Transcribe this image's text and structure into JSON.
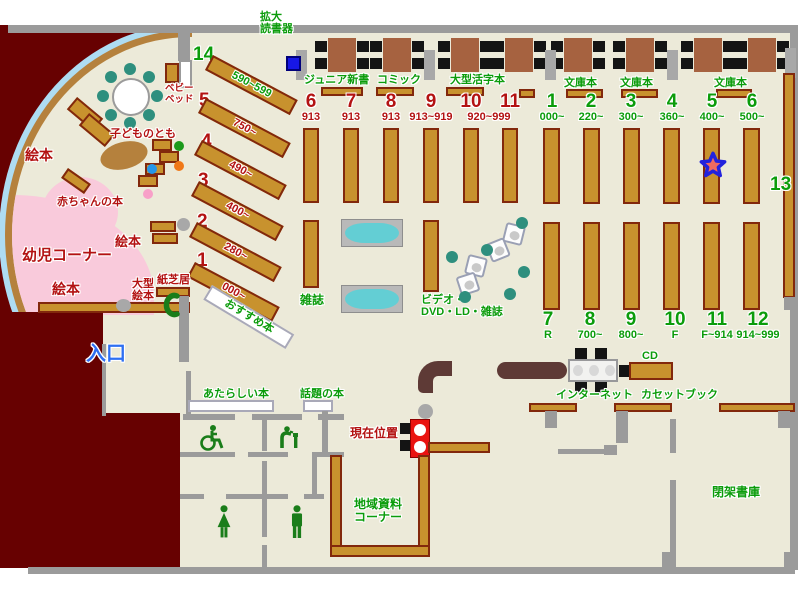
{
  "colors": {
    "floor": "#ecead9",
    "outside_wall": "#670101",
    "shelf": "#c8922e",
    "shelf_border": "#82280c",
    "wall_gray": "#9b9b9b",
    "table_brown": "#a66240",
    "label_green": "#0b9c0b",
    "label_red": "#b31212",
    "entrance_blue": "#2e6ff2",
    "infant_pink": "#f9cadb",
    "window_blue": "#aedcf2",
    "rack_cyan": "#63ced4",
    "seat_teal": "#2e8f7e",
    "counter_brown": "#5e3a36",
    "marker_red": "#ea1310",
    "star_fill": "#ee6a60",
    "star_ring": "#2222dd"
  },
  "top": {
    "magnifier_l1": "拡大",
    "magnifier_l2": "読書器",
    "junior": "ジュニア新書",
    "comic": "コミック",
    "large_print": "大型活字本",
    "bunko1": "文庫本",
    "bunko2": "文庫本",
    "bunko3": "文庫本"
  },
  "mid_columns": [
    {
      "num": "6",
      "range": "913"
    },
    {
      "num": "7",
      "range": "913"
    },
    {
      "num": "8",
      "range": "913"
    },
    {
      "num": "9",
      "range": "913~919"
    },
    {
      "num": "10",
      "range": "920~999"
    },
    {
      "num": "11",
      "range": ""
    }
  ],
  "right_top": [
    {
      "num": "1",
      "range": "000~"
    },
    {
      "num": "2",
      "range": "220~"
    },
    {
      "num": "3",
      "range": "300~"
    },
    {
      "num": "4",
      "range": "360~"
    },
    {
      "num": "5",
      "range": "400~"
    },
    {
      "num": "6",
      "range": "500~"
    }
  ],
  "right_bottom": [
    {
      "num": "7",
      "range": "R"
    },
    {
      "num": "8",
      "range": "700~"
    },
    {
      "num": "9",
      "range": "800~"
    },
    {
      "num": "10",
      "range": "F"
    },
    {
      "num": "11",
      "range": "F~914"
    },
    {
      "num": "12",
      "range": "914~999"
    }
  ],
  "diagonal": [
    {
      "num": "14",
      "range": "590~599"
    },
    {
      "num": "5",
      "range": "750~"
    },
    {
      "num": "4",
      "range": "490~"
    },
    {
      "num": "3",
      "range": "400~"
    },
    {
      "num": "2",
      "range": "280~"
    },
    {
      "num": "1",
      "range": "000~"
    }
  ],
  "side": {
    "number13": "13"
  },
  "children": {
    "corner": "幼児コーナー",
    "ehon1": "絵本",
    "ehon2": "絵本",
    "ehon3": "絵本",
    "baby_books": "赤ちゃんの本",
    "kodomo": "子どものとも",
    "bed_l1": "ベビー",
    "bed_l2": "ベッド",
    "large_l1": "大型",
    "large_l2": "絵本",
    "kamishibai": "紙芝居"
  },
  "center": {
    "magazines": "雑誌",
    "video_l1": "ビデオ・",
    "video_l2": "DVD・LD・雑誌",
    "recommended": "おすすめ本"
  },
  "service": {
    "cd": "CD",
    "internet": "インターネット",
    "cassette": "カセットブック",
    "current": "現在位置"
  },
  "rooms": {
    "entrance": "入口",
    "new_books": "あたらしい本",
    "topical": "話題の本",
    "local_l1": "地域資料",
    "local_l2": "コーナー",
    "closed": "閉架書庫"
  }
}
